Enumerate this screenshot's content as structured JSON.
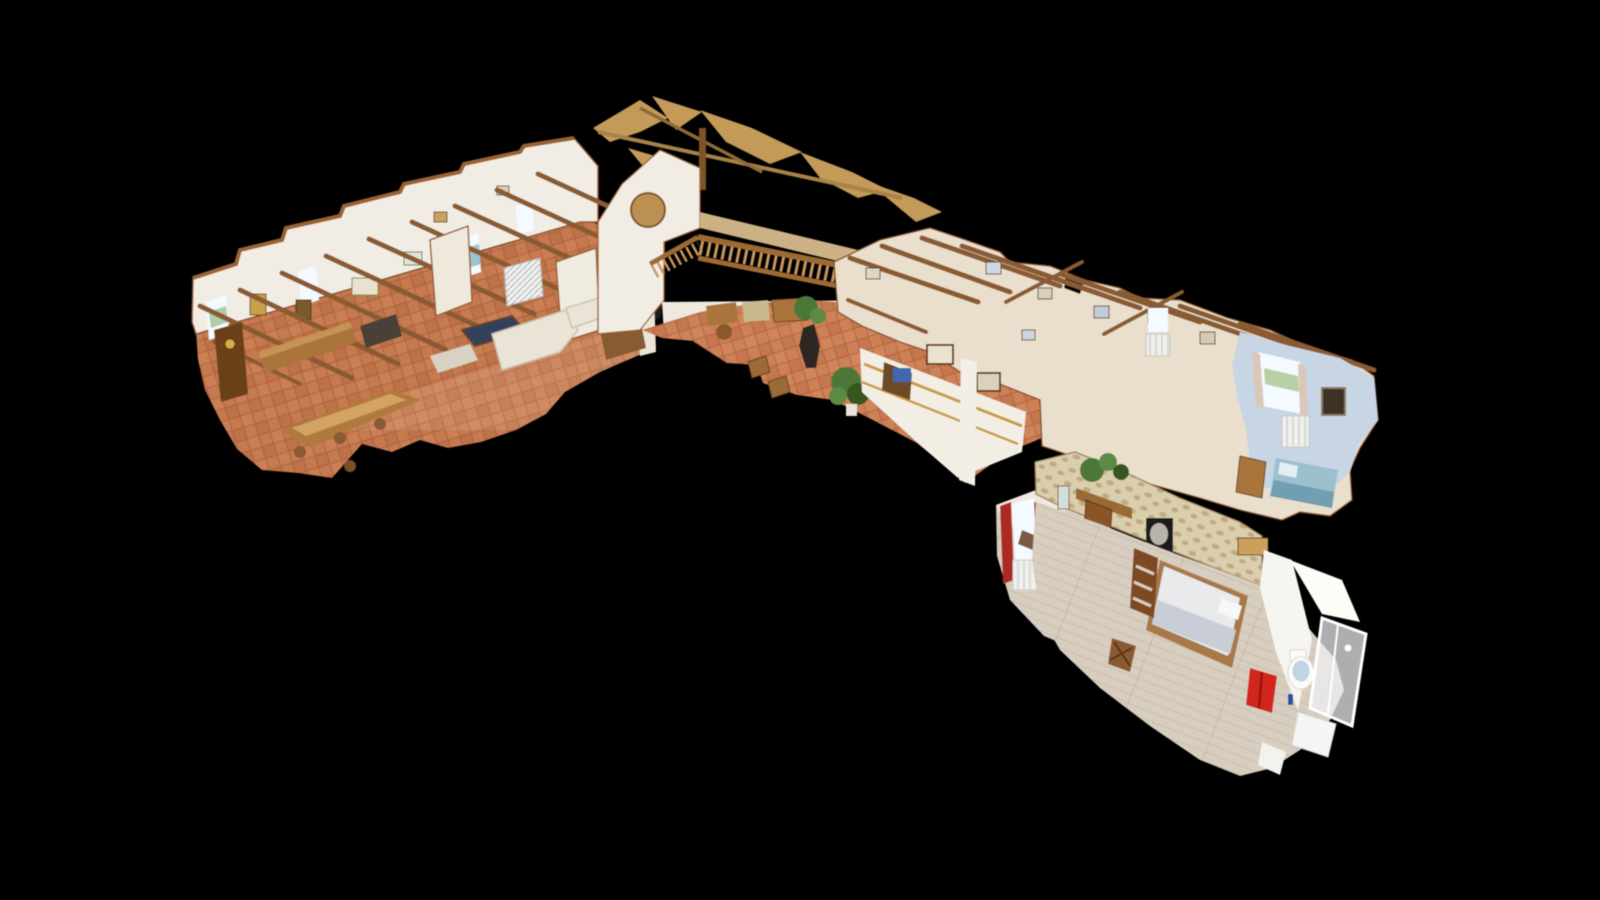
{
  "scene": {
    "kind": "3d-dollhouse-scan-view",
    "regions": [
      "living-dining-room",
      "entry-hall-mezzanine",
      "corridor",
      "blue-bedroom",
      "curtained-bedroom",
      "master-bedroom",
      "bathroom"
    ]
  },
  "colors": {
    "background": "#000000",
    "floor_terracotta": "#c57a50",
    "floor_terracotta_hall": "#cd8157",
    "wall_white": "#f2ede4",
    "wall_cream": "#e9dfcc",
    "cut_brown": "#8a5127",
    "beam_brown": "#8a5a31",
    "roof_tan": "#c49a58",
    "balustrade_wood": "#c9965a",
    "rail_wood": "#9c6a33",
    "wood_mid": "#a9743d",
    "wood_dark": "#6b4018",
    "sofa_white": "#eae4d6",
    "pool_table_navy": "#32415c",
    "plant_green": "#4c7837",
    "plant_dark": "#35571f",
    "accent_red": "#d2251a",
    "curtain_red": "#ac2a22",
    "stone_beige": "#dbcead",
    "plank_greige": "#d8cec0",
    "bed_linen": "#e9eaec",
    "bed_blanket": "#c9ced6",
    "blue_wall": "#c7d5e5",
    "blue_bed": "#9cc0ce",
    "window_glow": "#f4faff",
    "stained_glass_yellow": "#d9a832",
    "stained_glass_blue": "#5e85c0",
    "radiator_white": "#f0f1ee",
    "gold_trim": "#c99b3e",
    "statue_dark": "#2d2520"
  }
}
